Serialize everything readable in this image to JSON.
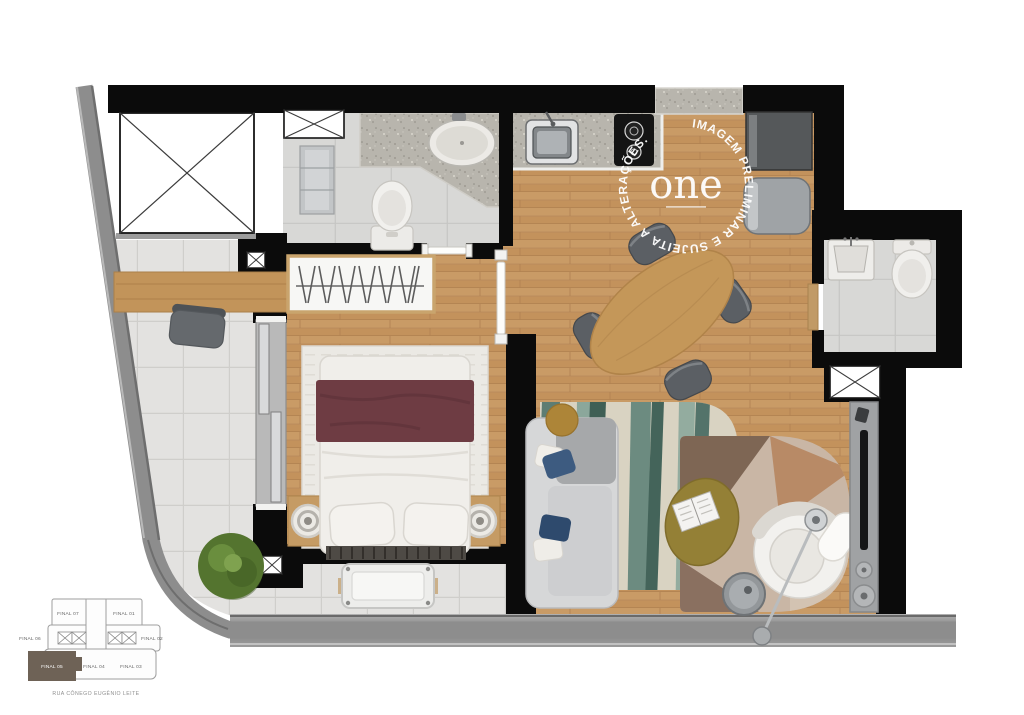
{
  "watermark": {
    "ring_text": "IMAGEM PRELIMINAR E SUJEITA A ALTERAÇÕES.",
    "logo_text": "one"
  },
  "key_plan": {
    "street_label": "RUA CÔNEGO EUGÊNIO LEITE",
    "highlighted_unit": "FINAL 05",
    "units": [
      {
        "label": "FINAL 07"
      },
      {
        "label": "FINAL 01"
      },
      {
        "label": "FINAL 06"
      },
      {
        "label": "FINAL 02"
      },
      {
        "label": "FINAL 05"
      },
      {
        "label": "FINAL 04"
      },
      {
        "label": "FINAL 03"
      }
    ]
  },
  "colors": {
    "wall_black": "#0b0b0b",
    "facade_gray": "#8d8d8d",
    "wood_floor": "#c99b66",
    "terrace_tile": "#e3e2e0",
    "bath_tile": "#d8d8d6",
    "granite_counter": "#b8b5ad",
    "rug_teal": "#5d7d73",
    "rug_geometric_beige": "#c9b6a5",
    "bed_throw_burgundy": "#6e3c43",
    "accent_mustard": "#ad8538",
    "plant_green": "#54742f",
    "keyplan_highlight": "#6e6256",
    "watermark_white": "#ffffff"
  }
}
